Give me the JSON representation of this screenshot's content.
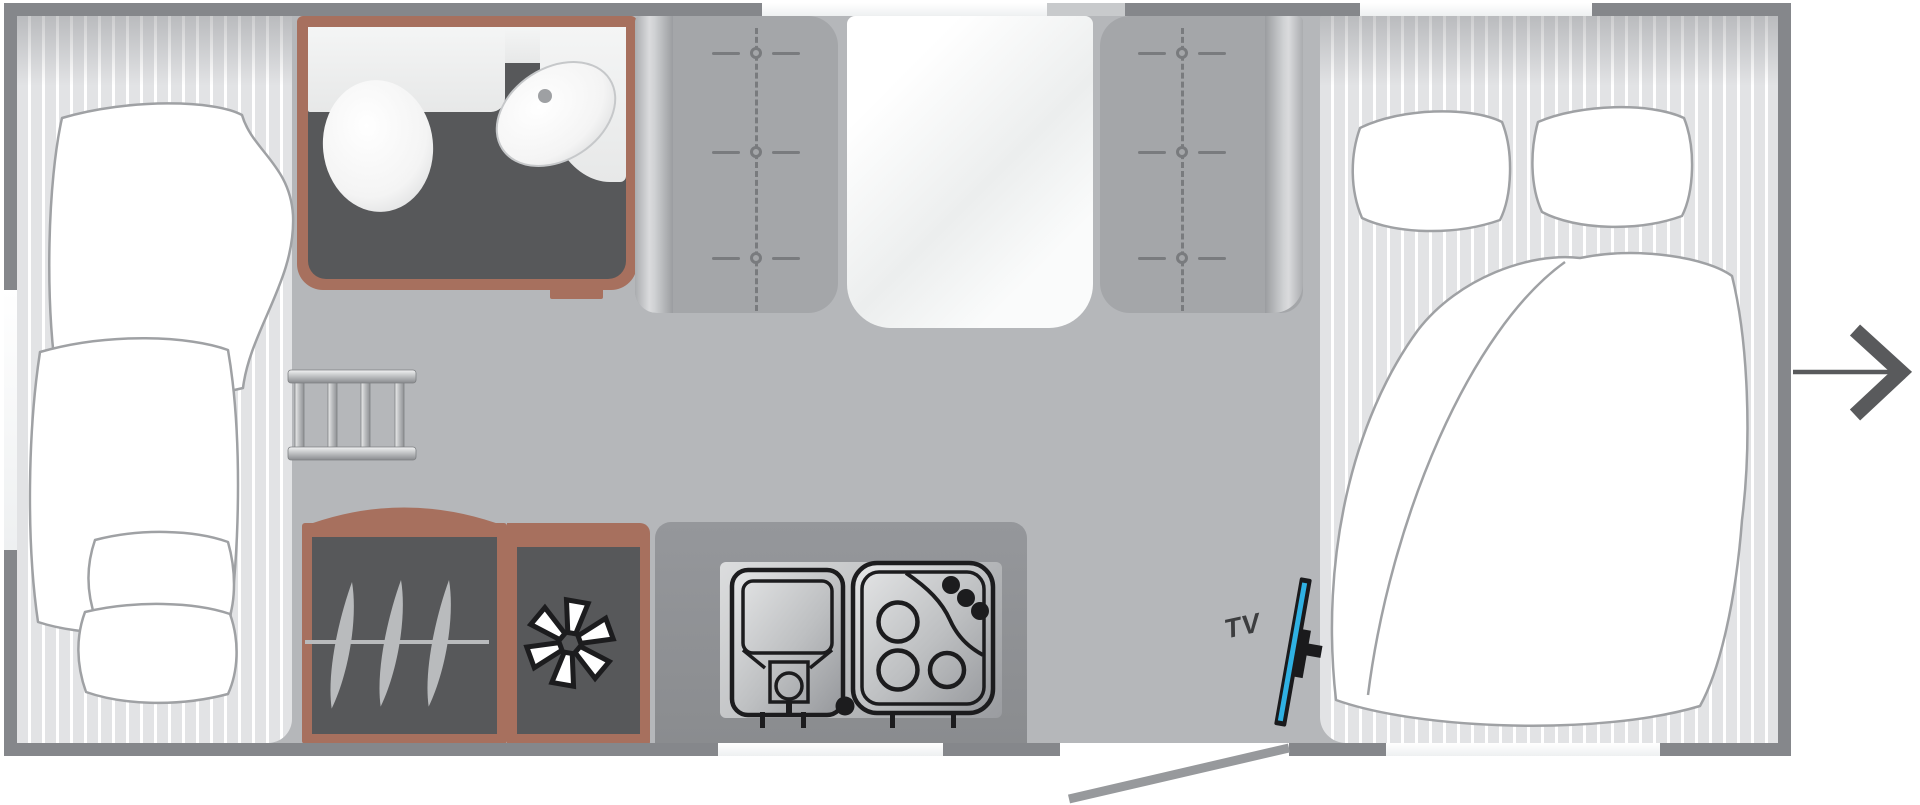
{
  "meta": {
    "type": "caravan-floor-plan",
    "orientation": "side-view-top-down",
    "entry_side": "right"
  },
  "labels": {
    "tv": "TV"
  },
  "colors": {
    "outside": "#ffffff",
    "wall": "#85878b",
    "wall-light": "#c8cacc",
    "window": "#eef0f1",
    "floor": "#b5b7ba",
    "stripe-bg": "#e2e3e5",
    "stripe-line": "#ffffff",
    "unit-dark": "#57585a",
    "accent-brown": "#a7705e",
    "seat": "#a4a6a9",
    "stitch": "#797b7e",
    "ink": "#1c1c1e",
    "icon-gray": "#b9bbbd",
    "fixture-white": "#ffffff",
    "tv-blue": "#2fb1e3",
    "tv-frame": "#1a1a1c",
    "label": "#3c3d3f",
    "door": "#97999c",
    "arrow": "#595a5c",
    "bedding-line": "#9fa1a4"
  },
  "areas": [
    {
      "name": "bunk-beds",
      "position": "left",
      "fixtures": [
        "duvet",
        "duvet",
        "pillow",
        "pillow"
      ]
    },
    {
      "name": "bathroom",
      "position": "front-center-left",
      "fixtures": [
        "toilet",
        "washbasin",
        "counter"
      ]
    },
    {
      "name": "ladder",
      "position": "center-left"
    },
    {
      "name": "dinette",
      "position": "front-center",
      "fixtures": [
        "bench-seat",
        "table",
        "bench-seat"
      ]
    },
    {
      "name": "wardrobe",
      "icon": "clothes-hangers-icon",
      "position": "rear-center-left"
    },
    {
      "name": "refrigerator",
      "icon": "snowflake-icon",
      "position": "rear-center"
    },
    {
      "name": "kitchen",
      "position": "rear-center",
      "fixtures": [
        "sink",
        "three-burner-hob"
      ]
    },
    {
      "name": "french-bed",
      "position": "right",
      "fixtures": [
        "pillow",
        "pillow",
        "duvet"
      ]
    },
    {
      "name": "tv-mount",
      "label": "TV",
      "position": "rear-right"
    },
    {
      "name": "entrance-door",
      "state": "open",
      "position": "rear-right"
    },
    {
      "name": "entry-arrow",
      "direction": "right",
      "position": "outside-right"
    }
  ]
}
